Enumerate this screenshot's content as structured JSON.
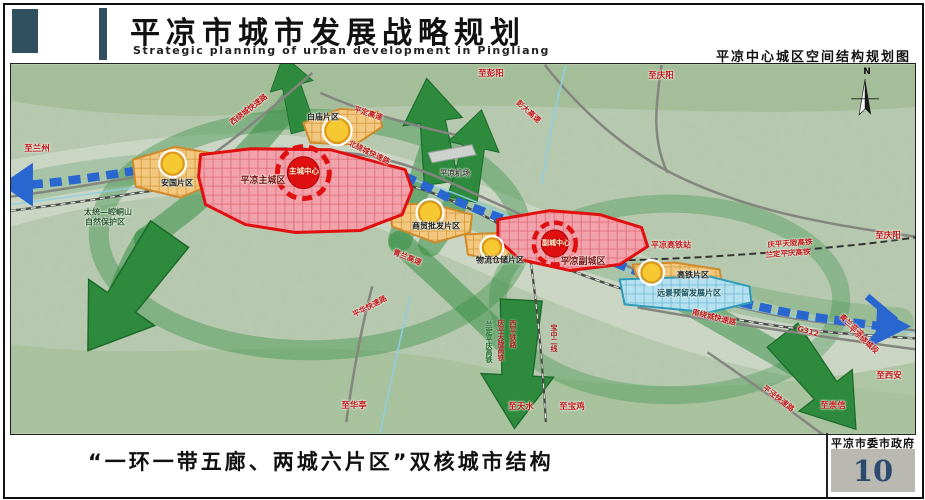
{
  "header": {
    "title": "平凉市城市发展战略规划",
    "subtitle": "Strategic planning of urban development in Pingliang",
    "map_title": "平凉中心城区空间结构规划图"
  },
  "map": {
    "compass": "N",
    "zones": {
      "baimiao": "白庙片区",
      "anguo": "安国片区",
      "main_city": "平凉主城区",
      "main_center": "主城中心",
      "shangmao": "商贸批发片区",
      "wuliu": "物流仓储片区",
      "sub_city": "平凉副城区",
      "sub_center": "副城中心",
      "gaotie": "高铁片区",
      "yuanjing": "远景预留发展片区"
    },
    "roads": {
      "xi_raocheng": "西绕城快速路",
      "pingding": "平定高速",
      "pengda": "彭大高速",
      "bei_raocheng": "北绕城快速路",
      "qinglan": "青兰高速",
      "pinghua": "平华快速路",
      "nan_raocheng": "南绕城快速路",
      "pingjing": "平泾快速路",
      "g312": "G312",
      "qinglan_duan1": "青兰高速",
      "qinglan_duan2": "平凉绕城段"
    },
    "railways": {
      "hsr1": "庆平天陇高铁",
      "hsr2": "兰定平庆高铁",
      "xiping": "西平铁路",
      "baozhong": "宝中二线",
      "station": "平凉高铁站"
    },
    "directions": {
      "lanzhou": "至兰州",
      "pengyang": "至彭阳",
      "qingyang": "至庆阳",
      "xian": "至西安",
      "chongxin": "至崇信",
      "huating": "至华亭",
      "tianshui": "至天水",
      "baoji": "至宝鸡"
    },
    "places": {
      "airport": "平凉机场",
      "nature1": "太统—崆峒山",
      "nature2": "自然保护区"
    },
    "colors": {
      "city_red": "#e01010",
      "zone_orange": "#e8a33c",
      "belt_blue": "#2a66d0",
      "corridor_green": "#2e8b3d",
      "reserve_blue": "#35a0c0"
    }
  },
  "footer": {
    "caption": "“一环一带五廊、两城六片区”双核城市结构",
    "agency": "平凉市委市政府",
    "page": "10"
  }
}
